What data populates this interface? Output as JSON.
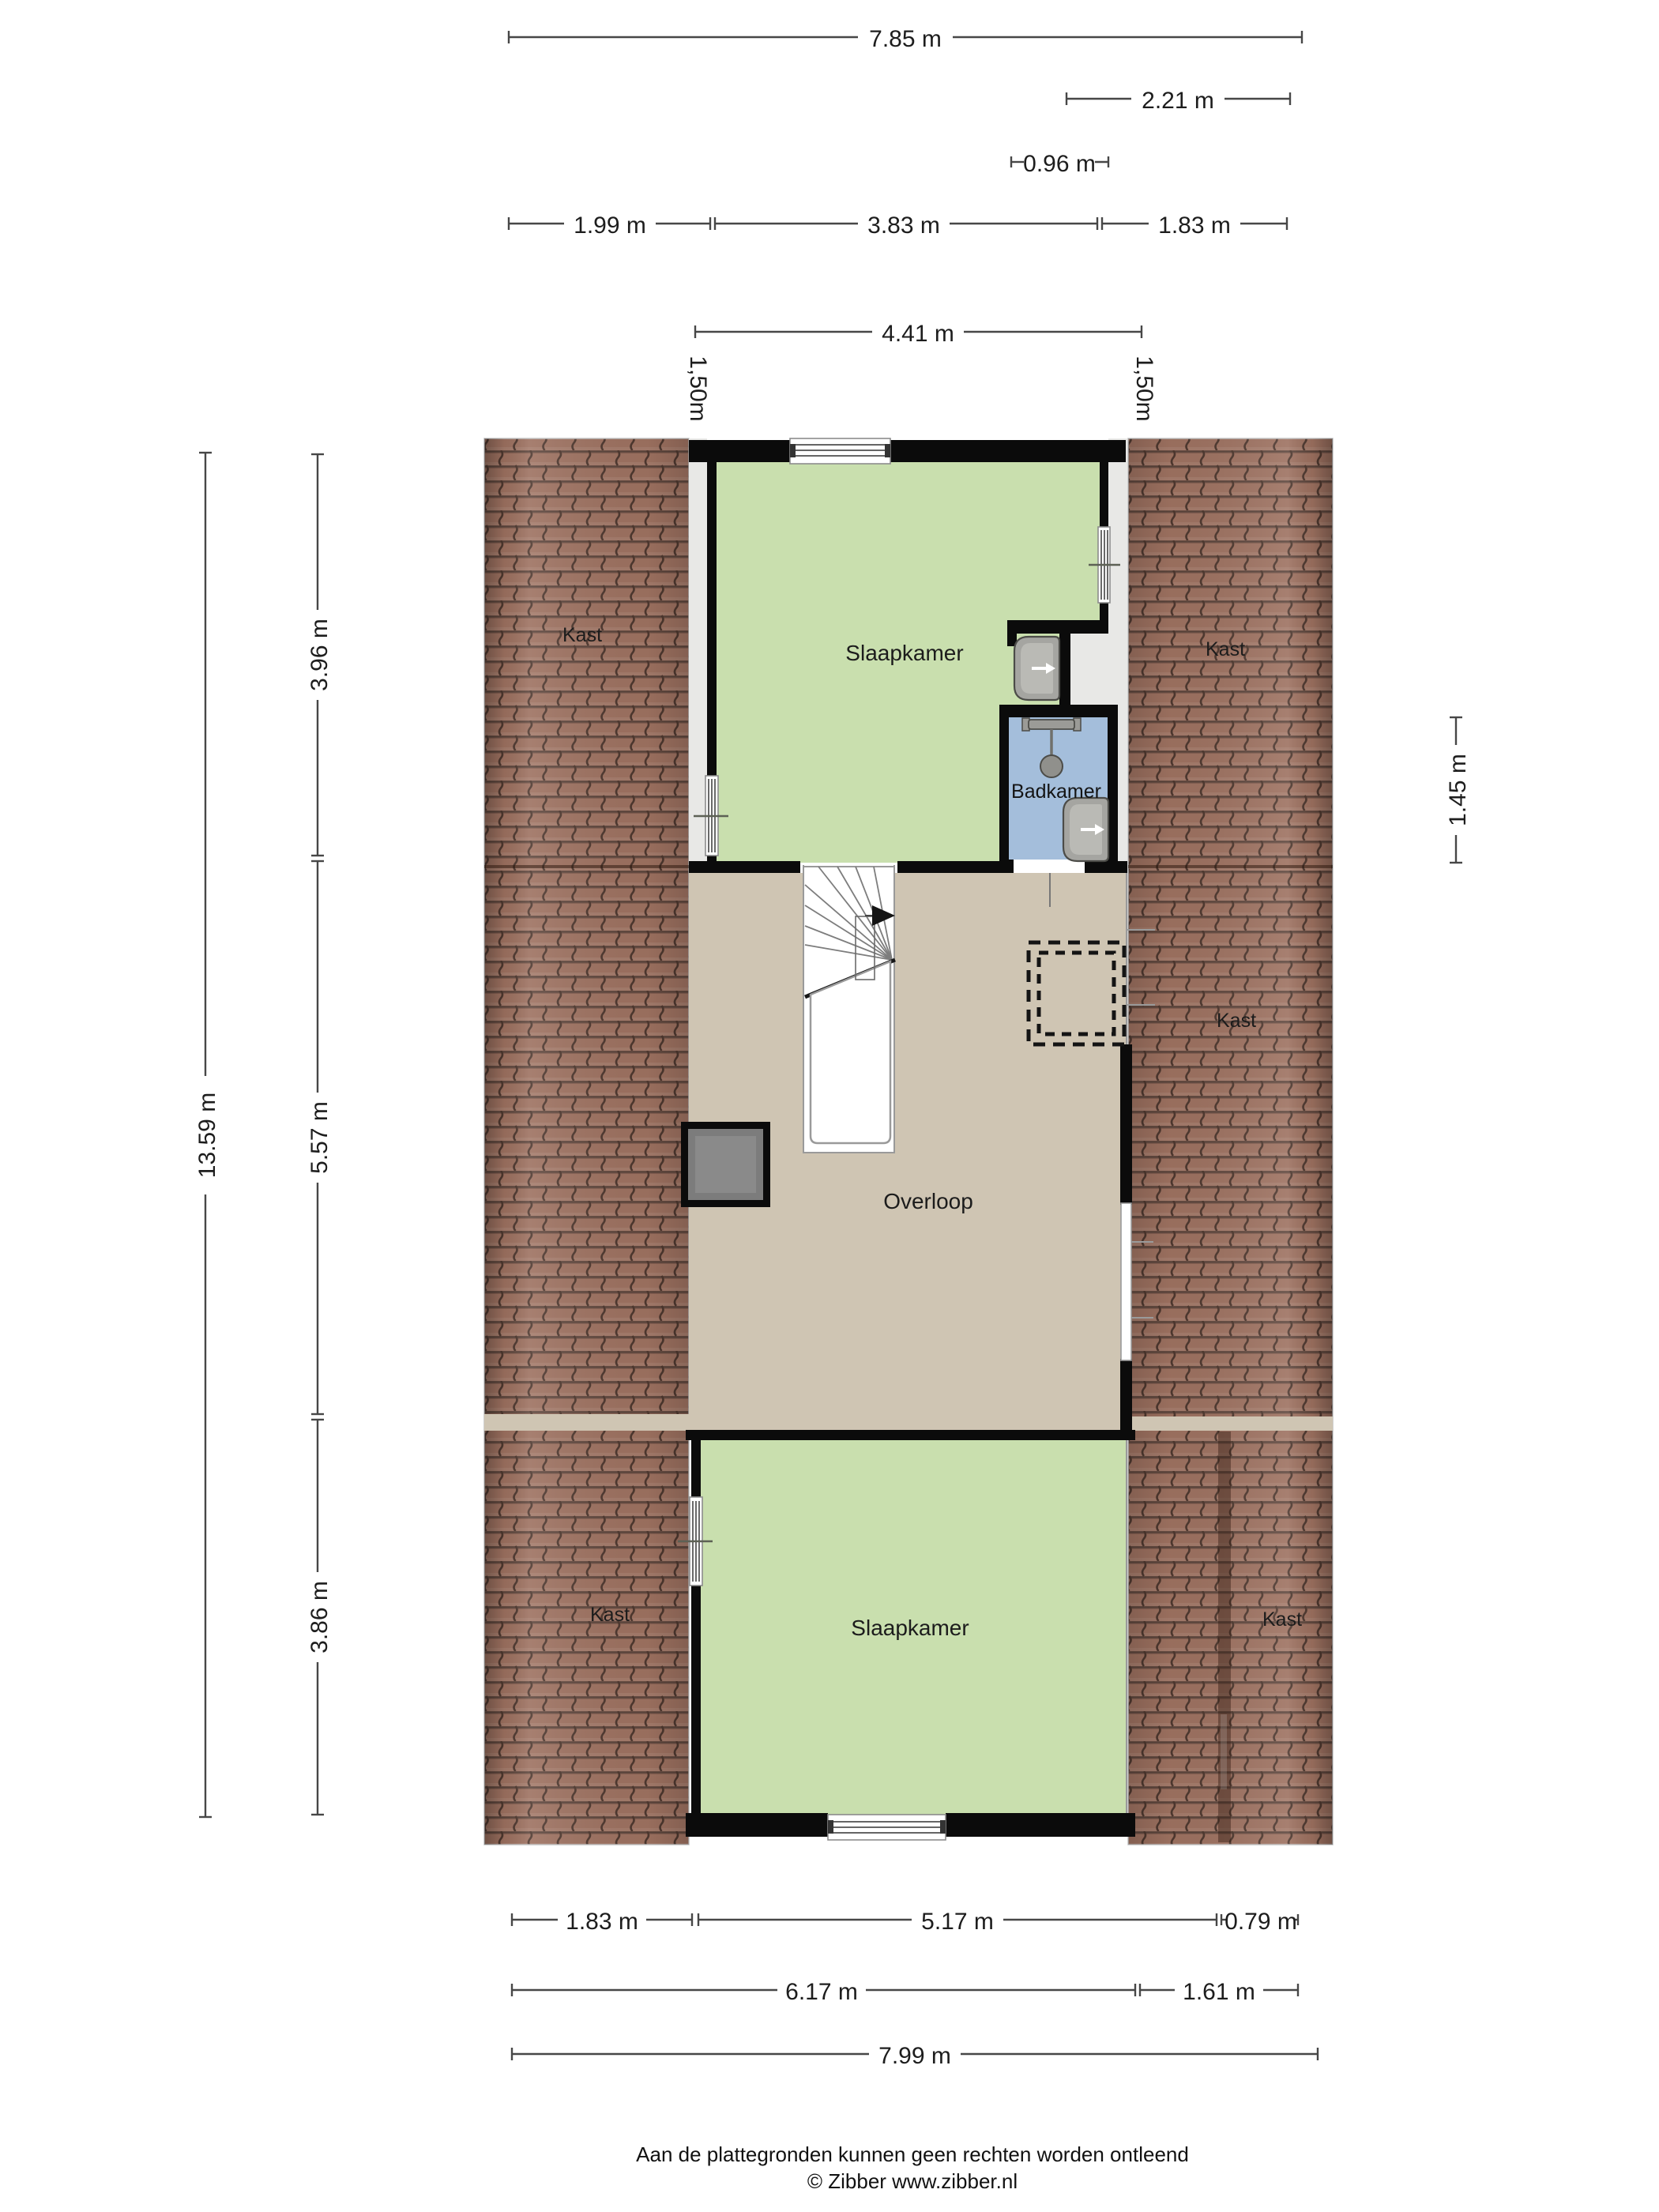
{
  "rooms": {
    "slaapkamer_top": "Slaapkamer",
    "slaapkamer_bottom": "Slaapkamer",
    "badkamer": "Badkamer",
    "overloop": "Overloop",
    "kast_top_left": "Kast",
    "kast_top_right": "Kast",
    "kast_middle_right": "Kast",
    "kast_bottom_left": "Kast",
    "kast_bottom_right": "Kast"
  },
  "dimensions": {
    "top_width_total": "7.85 m",
    "top_width_right": "2.21 m",
    "top_width_bathroom": "0.96 m",
    "top_left_segment": "1.99 m",
    "top_middle_segment": "3.83 m",
    "top_right_segment": "1.83 m",
    "top_interior_width": "4.41 m",
    "knee_height_left": "1,50m",
    "knee_height_right": "1,50m",
    "left_total_height": "13.59 m",
    "left_top_section": "3.96 m",
    "left_middle_section": "5.57 m",
    "left_bottom_section": "3.86 m",
    "right_bathroom_height": "1.45 m",
    "bottom_left_segment": "1.83 m",
    "bottom_middle_segment": "5.17 m",
    "bottom_right_segment": "0.79 m",
    "bottom_width_main": "6.17 m",
    "bottom_width_right": "1.61 m",
    "bottom_width_total": "7.99 m"
  },
  "footer": {
    "disclaimer": "Aan de plattegronden kunnen geen rechten worden ontleend",
    "credit": "© Zibber www.zibber.nl"
  },
  "colors": {
    "wall": "#0b0b0b",
    "bedroom": "#c9dfae",
    "landing": "#cfc5b3",
    "bathroom": "#a4bedb",
    "floor": "#e8e8e6",
    "brick": "#9d7160",
    "joint": "#4e382f",
    "dim": "#474747",
    "ink": "#1d1d1d"
  }
}
